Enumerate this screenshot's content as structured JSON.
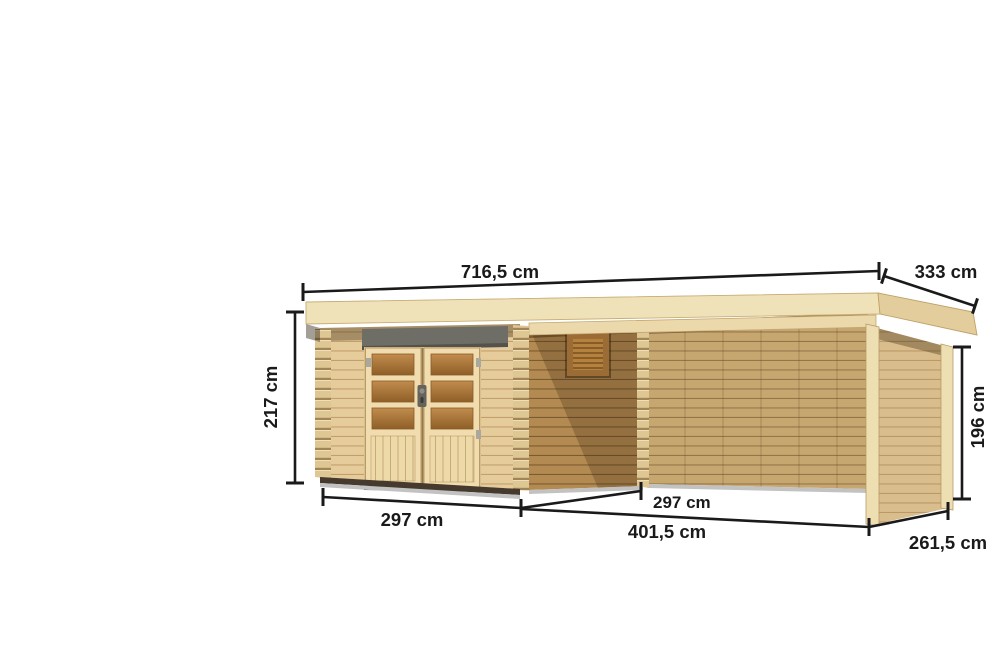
{
  "product_diagram": {
    "description": "wooden flat-roof garden house with side canopy annex, dimension drawing",
    "dimensions": {
      "total_width": "716,5 cm",
      "total_depth": "333 cm",
      "main_height": "217 cm",
      "side_height": "196 cm",
      "house_width": "297 cm",
      "house_depth": "297 cm",
      "annex_width": "401,5 cm",
      "annex_depth": "261,5 cm"
    },
    "colors": {
      "background": "#ffffff",
      "dimension_ink": "#1a1a1a",
      "roof_top": "#f5ebcf",
      "roof_front": "#f0e2b8",
      "roof_side": "#e3cd9c",
      "wall_front": "#e6cc9a",
      "wall_side": "#b28a52",
      "wall_back": "#c7a770",
      "wall_end": "#d9bd8c",
      "post": "#eedfb3",
      "log_strip": "#dfc794",
      "door_frame": "#f0dcae",
      "door_panel": "#eedaa9",
      "glass_top": "#c18c4e",
      "glass_bottom": "#8f5f28",
      "header_bar": "#6f6e66",
      "window_frame": "#9b6c35",
      "window_slats": "#b5813e",
      "base_dark": "#453a2d",
      "floor_gray": "#c2c2c2"
    }
  }
}
